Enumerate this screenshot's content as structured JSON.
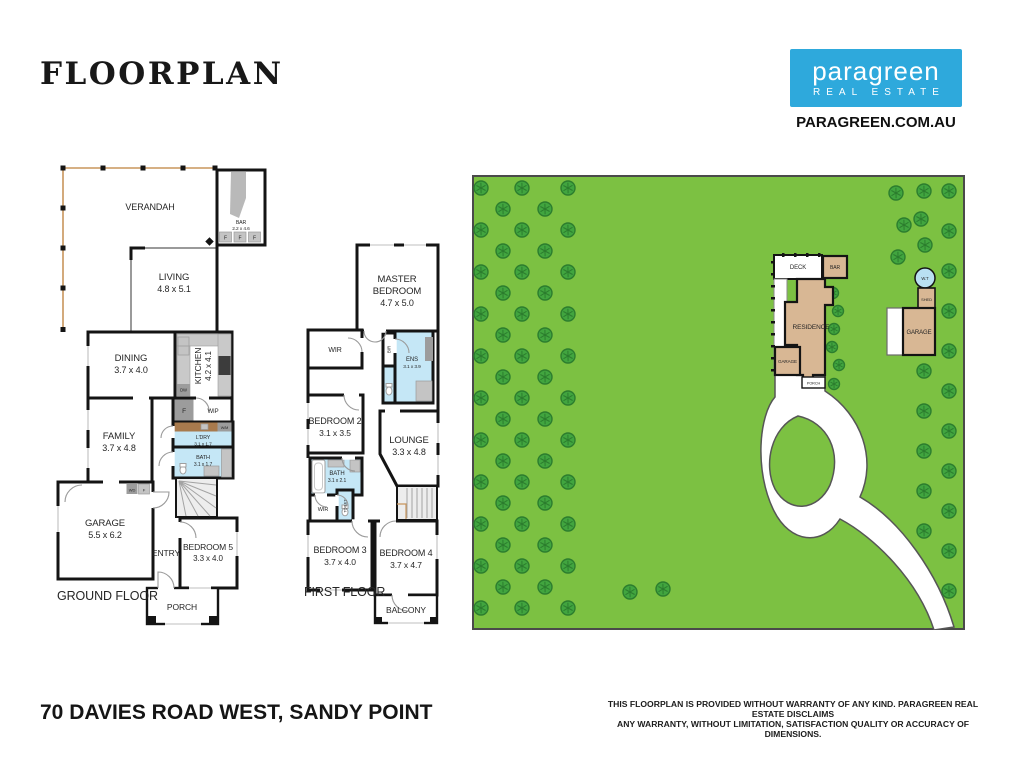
{
  "header": {
    "title": "FLOORPLAN",
    "brand": {
      "name": "paragreen",
      "subtitle": "REAL ESTATE",
      "website": "PARAGREEN.COM.AU",
      "brand_color": "#2ea9dc"
    }
  },
  "footer": {
    "address": "70 DAVIES ROAD WEST, SANDY POINT",
    "disclaimer_line1": "THIS FLOORPLAN IS PROVIDED WITHOUT WARRANTY OF ANY KIND. PARAGREEN REAL ESTATE DISCLAIMS",
    "disclaimer_line2": "ANY WARRANTY, WITHOUT LIMITATION, SATISFACTION QUALITY OR ACCURACY OF DIMENSIONS."
  },
  "ground_floor": {
    "floor_label": "GROUND FLOOR",
    "rooms": {
      "verandah": {
        "name": "VERANDAH"
      },
      "living": {
        "name": "LIVING",
        "dims": "4.8 x 5.1"
      },
      "bar": {
        "name": "BAR",
        "dims": "2.2 x 4.6"
      },
      "dining": {
        "name": "DINING",
        "dims": "3.7 x 4.0"
      },
      "kitchen": {
        "name": "KITCHEN",
        "dims": "4.2 x 4.1"
      },
      "wip": {
        "name": "WIP"
      },
      "ldry": {
        "name": "L'DRY",
        "dims": "3.1 x 1.7"
      },
      "bath": {
        "name": "BATH",
        "dims": "3.1 x 1.7"
      },
      "family": {
        "name": "FAMILY",
        "dims": "3.7 x 4.8"
      },
      "garage": {
        "name": "GARAGE",
        "dims": "5.5 x 6.2"
      },
      "entry": {
        "name": "ENTRY"
      },
      "bedroom5": {
        "name": "BEDROOM 5",
        "dims": "3.3 x 4.0"
      },
      "porch": {
        "name": "PORCH"
      }
    },
    "fixtures": {
      "dw": "DW",
      "f": "F",
      "wm": "W/M",
      "wd": "WD"
    }
  },
  "first_floor": {
    "floor_label": "FIRST FLOOR",
    "rooms": {
      "master": {
        "name_line1": "MASTER",
        "name_line2": "BEDROOM",
        "dims": "4.7 x 5.0"
      },
      "wir_master": {
        "name": "WIR"
      },
      "bir": {
        "name": "BIR"
      },
      "ens": {
        "name": "ENS",
        "dims": "3.1 x 3.9"
      },
      "bedroom2": {
        "name": "BEDROOM 2",
        "dims": "3.1 x 3.5"
      },
      "lounge": {
        "name": "LOUNGE",
        "dims": "3.3 x 4.8"
      },
      "bath": {
        "name": "BATH",
        "dims": "3.1 x 2.1"
      },
      "wir2": {
        "name": "WIR"
      },
      "toilet": {
        "name": "TOILET"
      },
      "bedroom3": {
        "name": "BEDROOM 3",
        "dims": "3.7 x 4.0"
      },
      "bedroom4": {
        "name": "BEDROOM 4",
        "dims": "3.7 x 4.7"
      },
      "balcony": {
        "name": "BALCONY"
      }
    }
  },
  "site_plan": {
    "labels": {
      "deck": "DECK",
      "bar": "BAR",
      "residence": "RESIDENCE",
      "garage_attached": "GARAGE",
      "porch": "PORCH",
      "water_tank": "W.T",
      "shed": "SHED",
      "garage_detached": "GARAGE"
    },
    "colors": {
      "grass": "#7cc142",
      "tree_fill": "#41a53f",
      "tree_stroke": "#2c7d2e",
      "building": "#d8b794",
      "wet_area": "#c5e7f6"
    },
    "trees": [
      [
        9,
        13
      ],
      [
        50,
        13
      ],
      [
        96,
        13
      ],
      [
        31,
        34
      ],
      [
        73,
        34
      ],
      [
        9,
        55
      ],
      [
        50,
        55
      ],
      [
        96,
        55
      ],
      [
        31,
        76
      ],
      [
        73,
        76
      ],
      [
        9,
        97
      ],
      [
        50,
        97
      ],
      [
        96,
        97
      ],
      [
        31,
        118
      ],
      [
        73,
        118
      ],
      [
        9,
        139
      ],
      [
        50,
        139
      ],
      [
        96,
        139
      ],
      [
        31,
        160
      ],
      [
        73,
        160
      ],
      [
        9,
        181
      ],
      [
        50,
        181
      ],
      [
        96,
        181
      ],
      [
        31,
        202
      ],
      [
        73,
        202
      ],
      [
        9,
        223
      ],
      [
        50,
        223
      ],
      [
        96,
        223
      ],
      [
        31,
        244
      ],
      [
        73,
        244
      ],
      [
        9,
        265
      ],
      [
        50,
        265
      ],
      [
        96,
        265
      ],
      [
        31,
        286
      ],
      [
        73,
        286
      ],
      [
        9,
        307
      ],
      [
        50,
        307
      ],
      [
        96,
        307
      ],
      [
        31,
        328
      ],
      [
        73,
        328
      ],
      [
        9,
        349
      ],
      [
        50,
        349
      ],
      [
        96,
        349
      ],
      [
        31,
        370
      ],
      [
        73,
        370
      ],
      [
        9,
        391
      ],
      [
        50,
        391
      ],
      [
        96,
        391
      ],
      [
        31,
        412
      ],
      [
        73,
        412
      ],
      [
        9,
        433
      ],
      [
        50,
        433
      ],
      [
        96,
        433
      ],
      [
        477,
        16
      ],
      [
        477,
        56
      ],
      [
        477,
        96
      ],
      [
        477,
        136
      ],
      [
        477,
        176
      ],
      [
        477,
        216
      ],
      [
        477,
        256
      ],
      [
        477,
        296
      ],
      [
        477,
        336
      ],
      [
        477,
        376
      ],
      [
        477,
        416
      ],
      [
        452,
        196
      ],
      [
        452,
        236
      ],
      [
        452,
        276
      ],
      [
        452,
        316
      ],
      [
        452,
        356
      ],
      [
        452,
        16
      ],
      [
        449,
        44
      ],
      [
        453,
        70
      ],
      [
        424,
        18
      ],
      [
        432,
        50
      ],
      [
        426,
        82
      ],
      [
        158,
        417
      ],
      [
        191,
        414
      ],
      [
        361,
        118,
        5.5
      ],
      [
        366,
        136,
        5.5
      ],
      [
        362,
        154,
        5.5
      ],
      [
        360,
        172,
        5.5
      ],
      [
        367,
        190,
        5.5
      ],
      [
        362,
        209,
        5.5
      ]
    ]
  }
}
